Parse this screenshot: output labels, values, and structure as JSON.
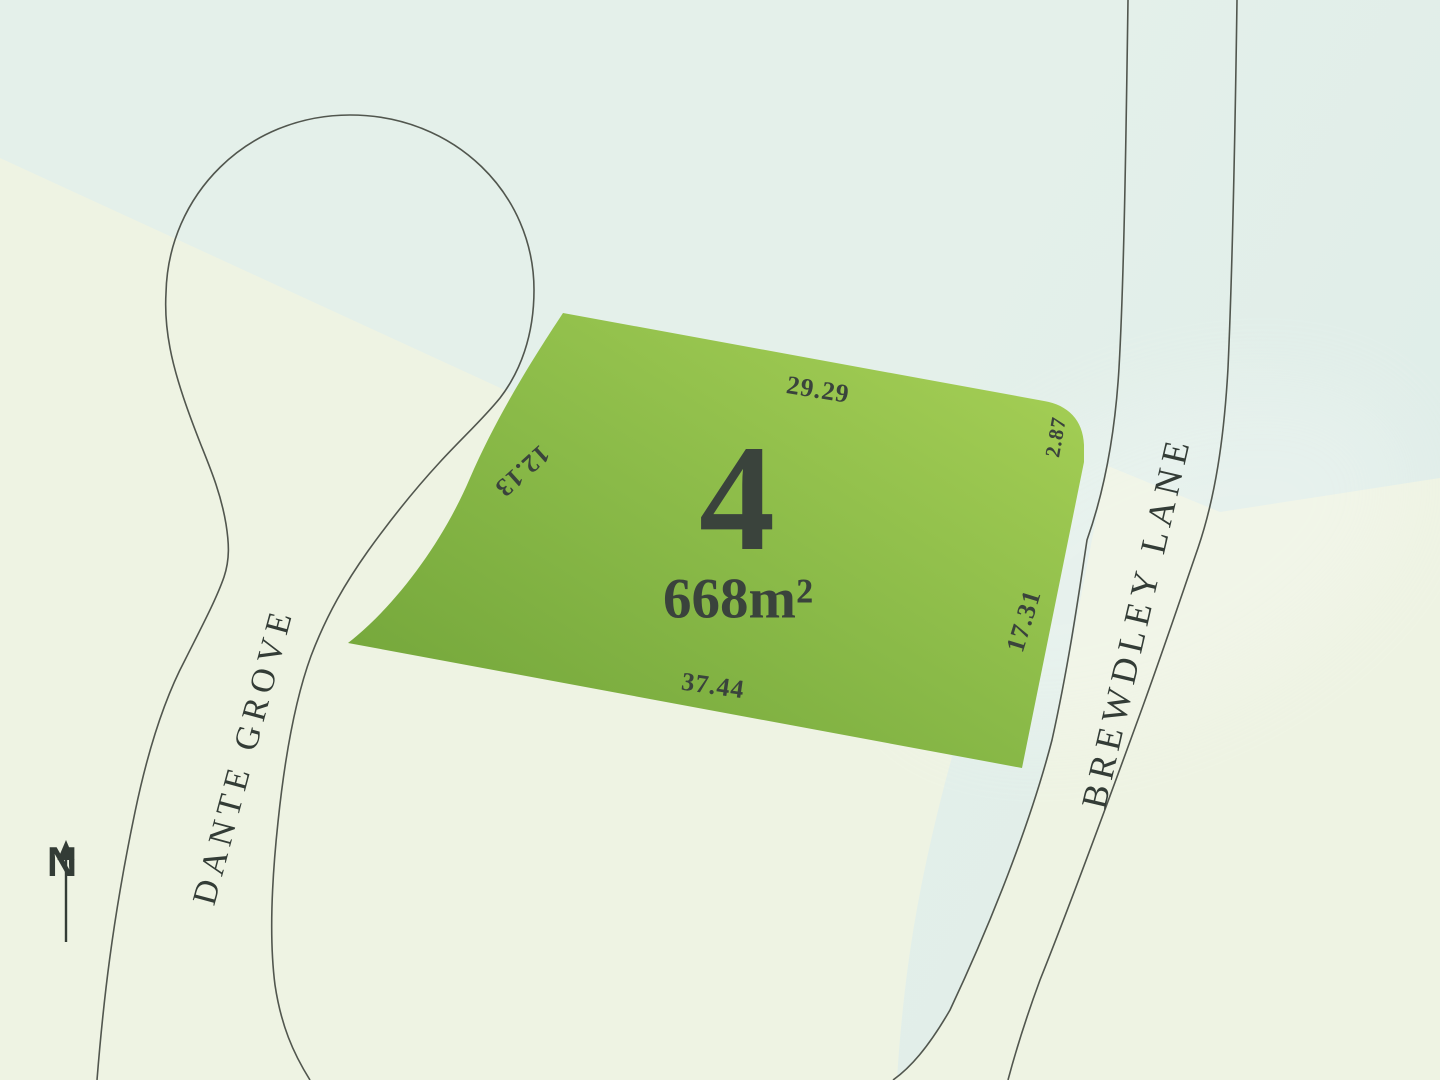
{
  "plan": {
    "lot": {
      "number": "4",
      "area": "668m²"
    },
    "dimensions": [
      {
        "id": "top",
        "value": "29.29"
      },
      {
        "id": "top-right",
        "value": "2.87"
      },
      {
        "id": "right",
        "value": "17.31"
      },
      {
        "id": "bottom",
        "value": "37.44"
      },
      {
        "id": "left",
        "value": "12.13"
      }
    ],
    "streets": [
      {
        "id": "dante-grove",
        "name": "DANTE GROVE"
      },
      {
        "id": "brewdley-lane",
        "name": "BREWDLEY LANE"
      }
    ],
    "compass": {
      "label": "N"
    }
  },
  "colors": {
    "bg-mint": "#e4f0ea",
    "bg-mint-deep": "#deece8",
    "bg-cream": "#eef3e3",
    "lot-green-dark": "#6fa238",
    "lot-green-mid": "#8aba48",
    "lot-green-light": "#a9d257",
    "road-line": "#51564e",
    "ink": "#3a433c",
    "street-ink": "#333c36"
  }
}
